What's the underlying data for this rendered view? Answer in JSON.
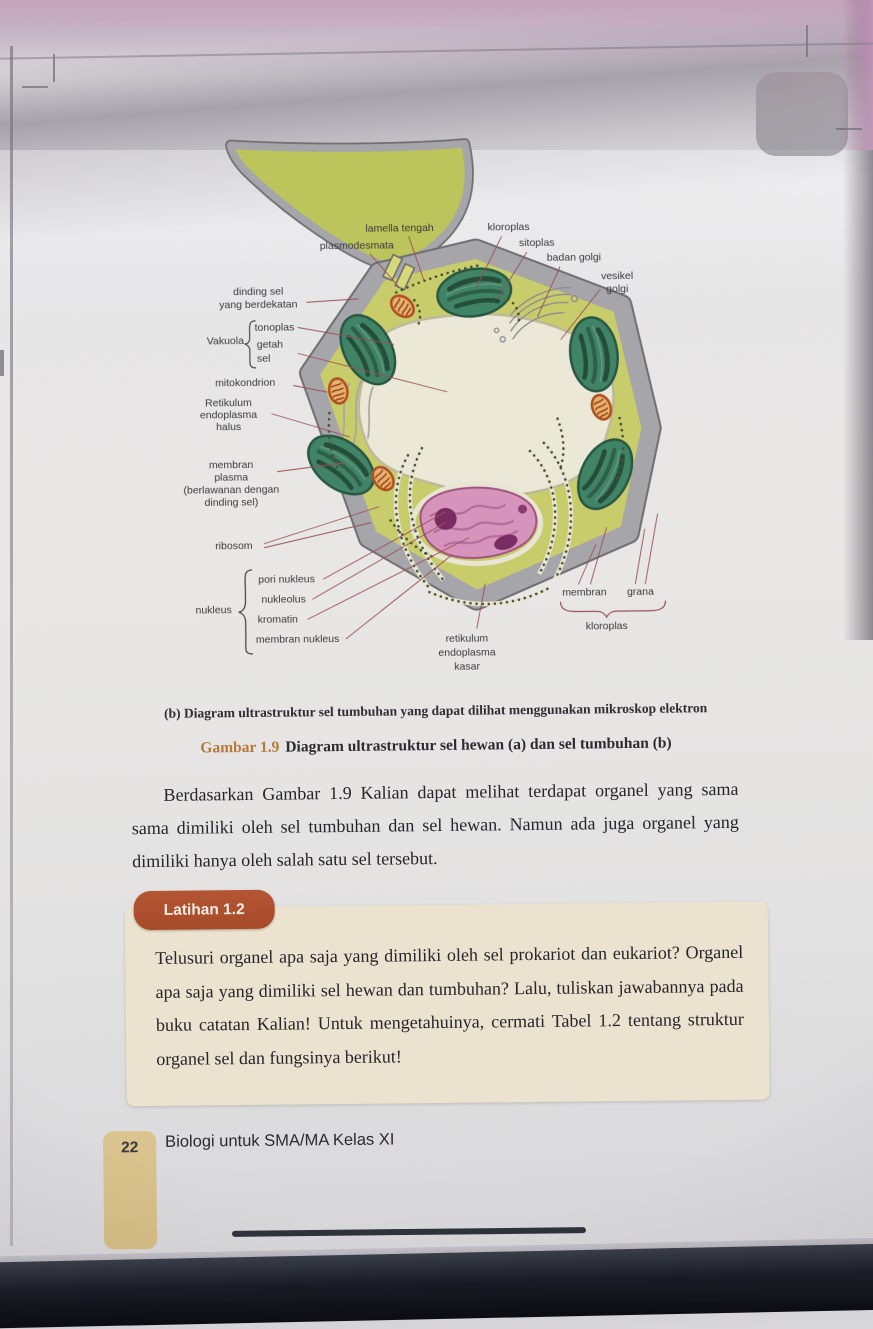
{
  "figure": {
    "panel_caption": "(b) Diagram ultrastruktur sel tumbuhan yang dapat dilihat menggunakan mikroskop elektron",
    "label": "Gambar 1.9",
    "caption": "Diagram ultrastruktur sel hewan (a) dan sel tumbuhan (b)"
  },
  "body_paragraph": "Berdasarkan Gambar 1.9 Kalian dapat melihat terdapat organel yang sama sama dimiliki oleh sel tumbuhan dan sel hewan. Namun ada juga organel yang dimiliki hanya oleh salah satu sel tersebut.",
  "exercise": {
    "badge_label": "Latihan 1.2",
    "text": "Telusuri organel apa saja yang dimiliki oleh sel prokariot dan eukariot? Organel apa saja yang dimiliki sel hewan dan tumbuhan? Lalu, tuliskan jawabannya pada buku catatan Kalian! Untuk mengetahuinya, cermati Tabel 1.2 tentang struktur organel sel dan fungsinya berikut!",
    "referenced_table": "Tabel 1.2"
  },
  "footer": {
    "page_number": "22",
    "book_title": "Biologi untuk SMA/MA Kelas XI"
  },
  "colors": {
    "exercise_badge": "#ac4e2d",
    "figure_label": "#b5793c",
    "exercise_box": "#ebe3cf",
    "page_tab": "#d9c18a",
    "cytoplasm": "#c9cc66",
    "adjacent_cell": "#bcc457",
    "cell_wall": "#a6a5a9",
    "vacuole": "#ece8d6",
    "chloroplast": "#3e8465",
    "mitochondrion": "#e0a265",
    "nucleus": "#d992bc",
    "nucleolus": "#7c2b63",
    "leader_line": "#9b5058"
  },
  "diagram": {
    "title": "Diagram ultrastruktur sel tumbuhan",
    "labels": [
      {
        "id": "lamella-tengah",
        "text": [
          "lamella tengah"
        ],
        "x": 404,
        "y": 231,
        "anchor": "middle",
        "leaders": [
          [
            413,
            236,
            428,
            281
          ]
        ]
      },
      {
        "id": "plasmodesmata",
        "text": [
          "plasmodesmata"
        ],
        "x": 361,
        "y": 248,
        "anchor": "middle",
        "leaders": [
          [
            374,
            253,
            403,
            287
          ]
        ]
      },
      {
        "id": "kloroplas-atas",
        "text": [
          "kloroplas"
        ],
        "x": 513,
        "y": 231,
        "anchor": "middle",
        "leaders": [
          [
            506,
            237,
            480,
            288
          ]
        ]
      },
      {
        "id": "sitoplas",
        "text": [
          "sitoplas"
        ],
        "x": 541,
        "y": 247,
        "anchor": "middle",
        "leaders": [
          [
            531,
            253,
            502,
            299
          ]
        ]
      },
      {
        "id": "badan-golgi",
        "text": [
          "badan golgi"
        ],
        "x": 578,
        "y": 262,
        "anchor": "middle",
        "leaders": [
          [
            564,
            268,
            541,
            318
          ]
        ]
      },
      {
        "id": "vesikel-golgi",
        "text": [
          "vesikel",
          "golgi"
        ],
        "x": 621,
        "y": 281,
        "lh": 13,
        "anchor": "middle",
        "leaders": [
          [
            604,
            291,
            564,
            341
          ]
        ]
      },
      {
        "id": "dinding-sel-yang-berdekatan",
        "text": [
          "dinding sel",
          "yang berdekatan"
        ],
        "x": 262,
        "y": 293,
        "lh": 13,
        "anchor": "middle",
        "leaders": [
          [
            310,
            301,
            362,
            298
          ]
        ]
      },
      {
        "id": "vakuola",
        "text": [
          "Vakuola"
        ],
        "x": 210,
        "y": 342,
        "anchor": "start"
      },
      {
        "id": "tonoplas",
        "text": [
          "tonoplas"
        ],
        "x": 258,
        "y": 329,
        "anchor": "start",
        "leaders": [
          [
            301,
            326,
            397,
            344
          ]
        ]
      },
      {
        "id": "getah-sel",
        "text": [
          "getah",
          "sel"
        ],
        "x": 260,
        "y": 346,
        "lh": 14,
        "anchor": "start",
        "leaders": [
          [
            301,
            352,
            450,
            392
          ]
        ]
      },
      {
        "id": "mitokondrion",
        "text": [
          "mitokondrion"
        ],
        "x": 248,
        "y": 384,
        "anchor": "middle",
        "leaders": [
          [
            296,
            384,
            330,
            391
          ]
        ]
      },
      {
        "id": "retikulum-endoplasma-halus",
        "text": [
          "Retikulum",
          "endoplasma",
          "halus"
        ],
        "x": 231,
        "y": 404,
        "lh": 12,
        "anchor": "middle",
        "leaders": [
          [
            274,
            412,
            352,
            436
          ]
        ]
      },
      {
        "id": "membran-plasma",
        "text": [
          "membran",
          "plasma",
          "(berlawanan dengan",
          "dinding sel)"
        ],
        "x": 233,
        "y": 466,
        "lh": 12.5,
        "anchor": "middle",
        "leaders": [
          [
            279,
            470,
            346,
            462
          ]
        ]
      },
      {
        "id": "ribosom",
        "text": [
          "ribosom"
        ],
        "x": 235,
        "y": 547,
        "anchor": "middle",
        "leaders": [
          [
            265,
            542,
            381,
            506
          ],
          [
            265,
            546,
            372,
            522
          ]
        ]
      },
      {
        "id": "pori-nukleus",
        "text": [
          "pori nukleus"
        ],
        "x": 259,
        "y": 581,
        "anchor": "start",
        "leaders": [
          [
            324,
            578,
            447,
            512
          ]
        ]
      },
      {
        "id": "nukleolus",
        "text": [
          "nukleolus"
        ],
        "x": 262,
        "y": 601,
        "anchor": "start",
        "leaders": [
          [
            313,
            598,
            448,
            522
          ]
        ]
      },
      {
        "id": "kromatin",
        "text": [
          "kromatin"
        ],
        "x": 258,
        "y": 621,
        "anchor": "start",
        "leaders": [
          [
            308,
            618,
            470,
            538
          ]
        ]
      },
      {
        "id": "membran-nukleus",
        "text": [
          "membran nukleus"
        ],
        "x": 256,
        "y": 641,
        "anchor": "start",
        "leaders": [
          [
            346,
            638,
            453,
            555
          ]
        ]
      },
      {
        "id": "nukleus",
        "text": [
          "nukleus"
        ],
        "x": 196,
        "y": 611,
        "anchor": "start"
      },
      {
        "id": "retikulum-endoplasma-kasar",
        "text": [
          "retikulum",
          "endoplasma",
          "kasar"
        ],
        "x": 467,
        "y": 642,
        "lh": 14,
        "anchor": "middle",
        "leaders": [
          [
            477,
            629,
            486,
            584
          ]
        ]
      },
      {
        "id": "membran-kloroplas",
        "text": [
          "membran"
        ],
        "x": 585,
        "y": 597,
        "anchor": "middle",
        "leaders": [
          [
            579,
            586,
            597,
            546
          ],
          [
            591,
            586,
            608,
            529
          ]
        ]
      },
      {
        "id": "grana",
        "text": [
          "grana"
        ],
        "x": 641,
        "y": 597,
        "anchor": "middle",
        "leaders": [
          [
            636,
            586,
            646,
            531
          ],
          [
            646,
            586,
            659,
            516
          ]
        ]
      },
      {
        "id": "kloroplas-bawah",
        "text": [
          "kloroplas"
        ],
        "x": 607,
        "y": 631,
        "anchor": "middle"
      }
    ]
  }
}
